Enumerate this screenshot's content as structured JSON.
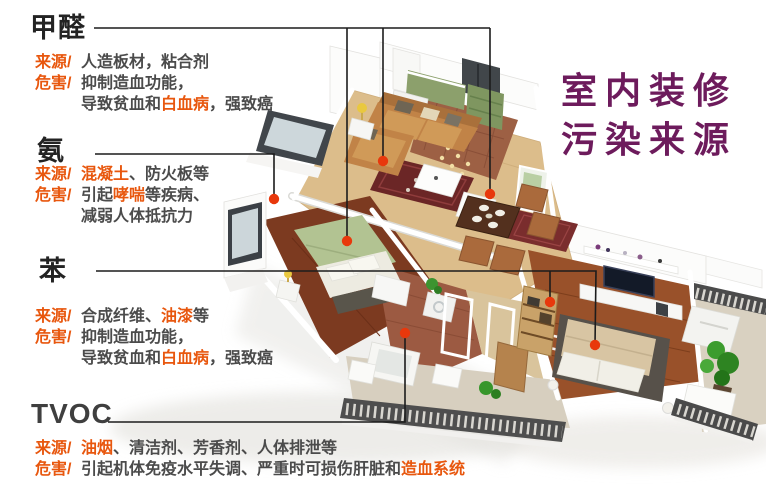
{
  "main_title": {
    "line1": "室内装修",
    "line2": "污染来源"
  },
  "colors": {
    "title_purple": "#6d1b5c",
    "accent_orange": "#e8570e",
    "body_text": "#4b4b4b",
    "heading_text": "#232323",
    "leader_line": "#1c1c1c",
    "dot": "#e8380c",
    "background": "#ffffff"
  },
  "icons": [
    {
      "name": "pollution-point-dot",
      "shape": "filled-circle",
      "color": "#e8380c"
    }
  ],
  "illustration": "3d-apartment-cutaway-render",
  "callouts": [
    {
      "id": "jiaquan",
      "title": "甲醛",
      "rows": [
        {
          "label": "来源/",
          "segments": [
            {
              "t": "人造板材，粘合剂",
              "hl": false
            }
          ]
        },
        {
          "label": "危害/",
          "segments": [
            {
              "t": "抑制造血功能，",
              "hl": false
            }
          ]
        },
        {
          "label": "",
          "segments": [
            {
              "t": "导致贫血和",
              "hl": false
            },
            {
              "t": "白血病",
              "hl": true
            },
            {
              "t": "，强致癌",
              "hl": false
            }
          ]
        }
      ],
      "leader": {
        "lines": [
          [
            [
              94,
              28
            ],
            [
              490,
              28
            ]
          ],
          [
            [
              347,
              28
            ],
            [
              347,
              241
            ]
          ],
          [
            [
              383,
              28
            ],
            [
              383,
              161
            ]
          ],
          [
            [
              490,
              28
            ],
            [
              490,
              194
            ]
          ]
        ],
        "dots": [
          [
            347,
            241
          ],
          [
            383,
            161
          ],
          [
            490,
            194
          ]
        ]
      }
    },
    {
      "id": "an",
      "title": "氨",
      "rows": [
        {
          "label": "来源/",
          "segments": [
            {
              "t": "混凝土",
              "hl": true
            },
            {
              "t": "、防火板等",
              "hl": false
            }
          ]
        },
        {
          "label": "危害/",
          "segments": [
            {
              "t": "引起",
              "hl": false
            },
            {
              "t": "哮喘",
              "hl": true
            },
            {
              "t": "等疾病、",
              "hl": false
            }
          ]
        },
        {
          "label": "",
          "segments": [
            {
              "t": "减弱人体抵抗力",
              "hl": false
            }
          ]
        }
      ],
      "leader": {
        "lines": [
          [
            [
              95,
              154
            ],
            [
              274,
              154
            ],
            [
              274,
              199
            ]
          ]
        ],
        "dots": [
          [
            274,
            199
          ]
        ]
      }
    },
    {
      "id": "ben",
      "title": "苯",
      "rows": [
        {
          "label": "来源/",
          "segments": [
            {
              "t": "合成纤维、",
              "hl": false
            },
            {
              "t": "油漆",
              "hl": true
            },
            {
              "t": "等",
              "hl": false
            }
          ]
        },
        {
          "label": "危害/",
          "segments": [
            {
              "t": "抑制造血功能，",
              "hl": false
            }
          ]
        },
        {
          "label": "",
          "segments": [
            {
              "t": "导致贫血和",
              "hl": false
            },
            {
              "t": "白血病",
              "hl": true
            },
            {
              "t": "，强致癌",
              "hl": false
            }
          ]
        }
      ],
      "leader": {
        "lines": [
          [
            [
              96,
              271
            ],
            [
              596,
              271
            ],
            [
              595,
              345
            ]
          ],
          [
            [
              550,
              271
            ],
            [
              550,
              302
            ]
          ]
        ],
        "dots": [
          [
            550,
            302
          ],
          [
            595,
            345
          ]
        ]
      }
    },
    {
      "id": "tvoc",
      "title": "TVOC",
      "rows": [
        {
          "label": "来源/",
          "segments": [
            {
              "t": "油烟",
              "hl": true
            },
            {
              "t": "、清洁剂、芳香剂、人体排泄等",
              "hl": false
            }
          ]
        },
        {
          "label": "危害/",
          "segments": [
            {
              "t": "引起机体免疫水平失调、严重时可损伤肝脏和",
              "hl": false
            },
            {
              "t": "造血系统",
              "hl": true
            }
          ]
        }
      ],
      "leader": {
        "lines": [
          [
            [
              108,
              422
            ],
            [
              405,
              422
            ],
            [
              405,
              333
            ]
          ]
        ],
        "dots": [
          [
            405,
            333
          ]
        ]
      }
    }
  ]
}
